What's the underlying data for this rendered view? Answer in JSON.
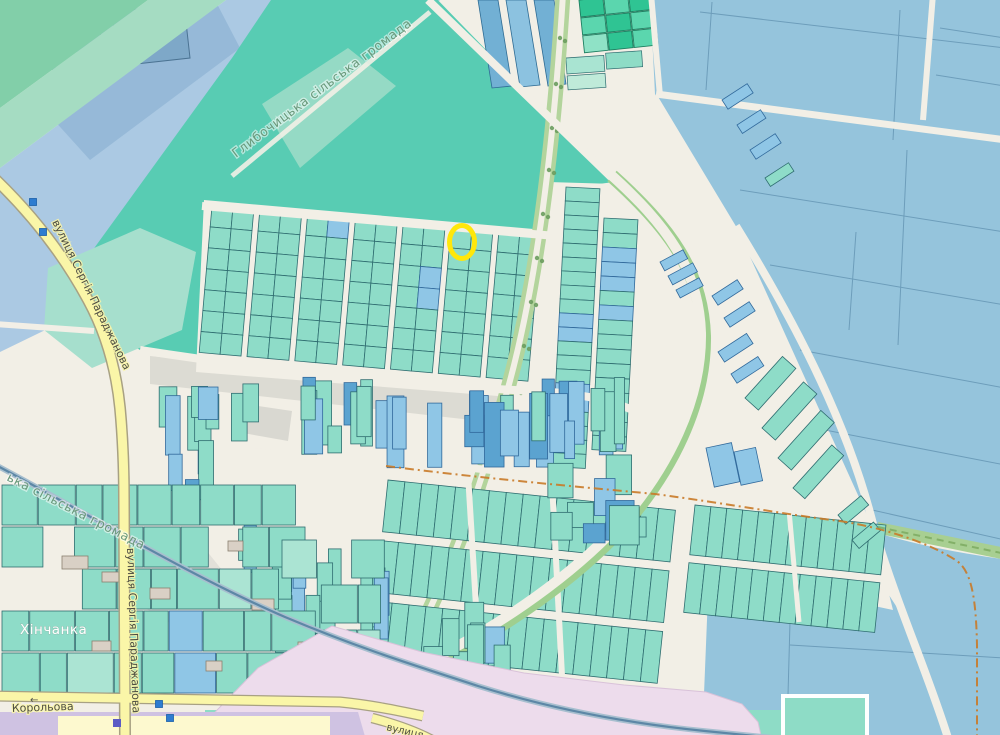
{
  "map": {
    "labels": {
      "boundary_top": {
        "text": "Глибочицька сільська громада",
        "tf": "translate(236 158) rotate(-37)"
      },
      "boundary_left": {
        "text": "ька сільська громада",
        "tf": "translate(6 480) rotate(27)"
      },
      "street_paradzhanova_upper": {
        "text": "вулиця Сергія Параджанова",
        "tf": "translate(52 222) rotate(64)"
      },
      "street_paradzhanova_lower": {
        "text": "вулиця Сергія Параджанова",
        "tf": "translate(127 548) rotate(88)"
      },
      "street_korolova": {
        "text": "Корольова",
        "tf": "translate(12 712) rotate(-2)"
      },
      "street_bottom": {
        "text": "вулиця",
        "tf": "translate(386 730) rotate(13)"
      },
      "place_khinchanka": {
        "text": "Хінчанка",
        "tf": "translate(20 634)"
      },
      "oneway_arrow": {
        "glyph": "←",
        "tf": "translate(30 703)"
      }
    },
    "selection_marker": {
      "cx": 462,
      "cy": 242,
      "rx": 12.5,
      "ry": 16.5,
      "color": "#ffe70a",
      "stroke_width": 5
    },
    "poi_markers": [
      {
        "x": 33,
        "y": 202
      },
      {
        "x": 43,
        "y": 232
      },
      {
        "x": 159,
        "y": 704
      },
      {
        "x": 170,
        "y": 718
      }
    ],
    "station_marker": {
      "x": 113,
      "y": 719,
      "color": "#5b5bc4"
    },
    "colors": {
      "cream": "#f2efe6",
      "field": "#58ccb3",
      "teal": "#8edcc8",
      "tealStroke": "#2f6d70",
      "ltTeal": "#abe4d3",
      "blue": "#8fc6e6",
      "blueStroke": "#31699b",
      "darkBlue": "#5ba3d0",
      "bigBlue": "#95c4dc",
      "bandBlue": "#abc9e3",
      "building": "#7ea8c8",
      "emerald": "#2fc493",
      "emerald2": "#5bd6ae",
      "pink": "#eddcec",
      "lavender": "#cfc2e2",
      "paleYellow": "#fdf9cf",
      "yellowRoad": "#faf6a8",
      "yellowCasing": "#a8a183",
      "greenStrip": "#b3d49c",
      "tree": "#6a9c5e",
      "admin": "#c97a28",
      "greenDash": "#79a85e",
      "rail": "#5d87a6",
      "railCasing": "#a8bfcf",
      "poi": "#2e7cd0",
      "gray": "#dcdbd3",
      "bldgFill": "#d9d0c5",
      "bldgStroke": "#8a8070"
    },
    "generated": {
      "grid1": {
        "x": 212,
        "y": 206,
        "rot": 5,
        "groups": 7,
        "cols": 2,
        "cw": 21,
        "lane": 6,
        "rows": 7,
        "rh": 21,
        "blues": [
          [
            2,
            0,
            1
          ],
          [
            4,
            2,
            1
          ],
          [
            4,
            3,
            1
          ]
        ]
      },
      "stacks": [
        {
          "x": 566,
          "y": 187,
          "rot": 3,
          "w": 34,
          "h": 14,
          "n": 20,
          "blues": [
            9,
            10,
            14,
            15
          ]
        },
        {
          "x": 604,
          "y": 218,
          "rot": 3,
          "w": 34,
          "h": 14.5,
          "n": 16,
          "blues": [
            2,
            3,
            4,
            6
          ]
        }
      ],
      "allot": [
        {
          "x": 388,
          "y": 480,
          "rot": 6,
          "cols": 17,
          "cw": 17,
          "bands": 3,
          "ch": 52,
          "gap": 9
        },
        {
          "x": 695,
          "y": 505,
          "rot": 6,
          "cols": 12,
          "cw": 16,
          "bands": 2,
          "ch": 50,
          "gap": 8
        }
      ],
      "scatters": [
        {
          "seed": 7,
          "x0": 300,
          "x1": 630,
          "y0": 376,
          "y1": 468,
          "n": 36,
          "wMin": 9,
          "wMax": 20,
          "hMin": 26,
          "hMax": 72,
          "pTeal": 0.5,
          "pBlue": 0.32
        },
        {
          "seed": 13,
          "x0": 150,
          "x1": 298,
          "y0": 382,
          "y1": 522,
          "n": 13,
          "wMin": 12,
          "wMax": 22,
          "hMin": 28,
          "hMax": 62,
          "pTeal": 0.75,
          "pBlue": 0.15
        },
        {
          "seed": 21,
          "x0": 235,
          "x1": 400,
          "y0": 516,
          "y1": 655,
          "n": 16,
          "wMin": 11,
          "wMax": 20,
          "hMin": 30,
          "hMax": 66,
          "pTeal": 0.6,
          "pBlue": 0.28
        },
        {
          "seed": 31,
          "x0": 545,
          "x1": 652,
          "y0": 452,
          "y1": 552,
          "n": 10,
          "wMin": 16,
          "wMax": 30,
          "hMin": 18,
          "hMax": 44,
          "pTeal": 0.7,
          "pBlue": 0.2
        },
        {
          "seed": 41,
          "x0": 420,
          "x1": 540,
          "y0": 600,
          "y1": 686,
          "n": 8,
          "wMin": 14,
          "wMax": 24,
          "hMin": 24,
          "hMax": 48,
          "pTeal": 0.8,
          "pBlue": 0.1
        },
        {
          "seed": 51,
          "x0": 205,
          "x1": 400,
          "y0": 700,
          "y1": 730,
          "n": 9,
          "wMin": 14,
          "wMax": 26,
          "hMin": 22,
          "hMax": 32,
          "pTeal": 0.8,
          "pBlue": 0.1
        },
        {
          "seed": 61,
          "x0": 600,
          "x1": 700,
          "y0": 702,
          "y1": 730,
          "n": 5,
          "wMin": 14,
          "wMax": 24,
          "hMin": 20,
          "hMax": 30,
          "pTeal": 0.85,
          "pBlue": 0.1
        }
      ],
      "khin": [
        {
          "seed": 11,
          "rows": [
            485,
            527,
            569,
            611,
            653
          ],
          "h": 40,
          "x0": 2,
          "x1": 272,
          "wMin": 24,
          "wMax": 46,
          "skip": 0.12
        },
        {
          "seed": 5,
          "rows": [
            540,
            585,
            630
          ],
          "h": 38,
          "x0": 282,
          "x1": 362,
          "wMin": 22,
          "wMax": 40,
          "skip": 0.3
        }
      ],
      "herringbone": [
        [
          660,
          262,
          26,
          10,
          -28,
          "B"
        ],
        [
          668,
          276,
          28,
          10,
          -28,
          "B"
        ],
        [
          676,
          290,
          26,
          9,
          -28,
          "B"
        ],
        [
          722,
          100,
          30,
          11,
          -33,
          "B"
        ],
        [
          737,
          125,
          28,
          10,
          -33,
          "B"
        ],
        [
          750,
          150,
          30,
          11,
          -33,
          "B"
        ],
        [
          765,
          178,
          28,
          10,
          -33,
          "T"
        ],
        [
          712,
          296,
          30,
          11,
          -33,
          "B"
        ],
        [
          724,
          318,
          30,
          11,
          -33,
          "B"
        ],
        [
          718,
          352,
          34,
          12,
          -33,
          "B"
        ],
        [
          731,
          374,
          32,
          11,
          -33,
          "B"
        ],
        [
          745,
          398,
          56,
          18,
          -48,
          "T"
        ],
        [
          762,
          428,
          62,
          18,
          -48,
          "T"
        ],
        [
          778,
          458,
          64,
          18,
          -48,
          "T"
        ],
        [
          793,
          488,
          58,
          16,
          -48,
          "T"
        ],
        [
          706,
          448,
          26,
          40,
          -12,
          "B"
        ],
        [
          734,
          452,
          22,
          34,
          -12,
          "B"
        ],
        [
          838,
          515,
          30,
          12,
          -40,
          "T"
        ],
        [
          852,
          540,
          28,
          11,
          -40,
          "T"
        ]
      ],
      "trees": [
        [
          560,
          38
        ],
        [
          556,
          84
        ],
        [
          552,
          128
        ],
        [
          549,
          170
        ],
        [
          543,
          214
        ],
        [
          537,
          258
        ],
        [
          531,
          302
        ],
        [
          524,
          346
        ],
        [
          516,
          390
        ]
      ],
      "buildings": [
        [
          62,
          556,
          26,
          13
        ],
        [
          102,
          572,
          18,
          10
        ],
        [
          150,
          588,
          20,
          11
        ],
        [
          228,
          541,
          15,
          10
        ],
        [
          252,
          599,
          22,
          11
        ],
        [
          298,
          642,
          17,
          10
        ],
        [
          206,
          661,
          16,
          10
        ],
        [
          92,
          641,
          19,
          10
        ],
        [
          286,
          712,
          24,
          11
        ],
        [
          332,
          713,
          17,
          10
        ]
      ]
    }
  }
}
